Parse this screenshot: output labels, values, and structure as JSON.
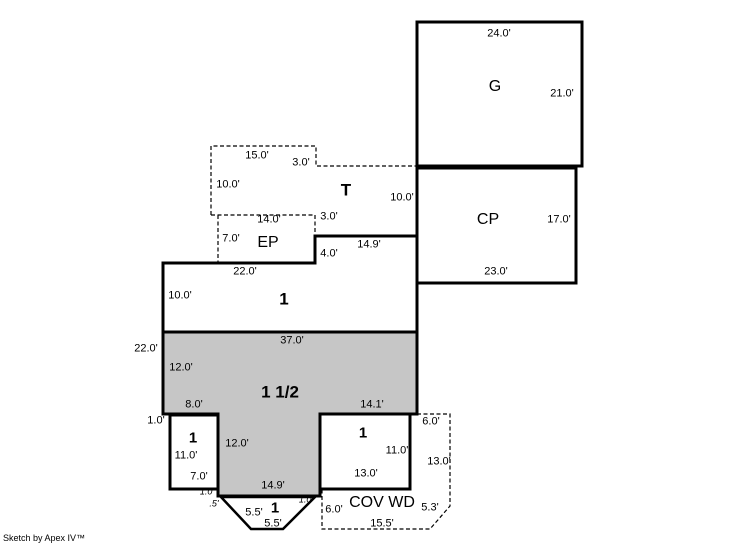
{
  "colors": {
    "background": "#ffffff",
    "line": "#000000",
    "shade": "#c6c6c6"
  },
  "sketch": {
    "garage": {
      "label": "G",
      "dim_top": "24.0'",
      "dim_right": "21.0'"
    },
    "carport": {
      "label": "CP",
      "dim_right": "17.0'",
      "dim_bottom": "23.0'"
    },
    "terrace": {
      "label": "T",
      "dim_top": "15.0'",
      "dim_top_step": "3.0'",
      "dim_left": "10.0'",
      "dim_right": "10.0'"
    },
    "enclosed_porch": {
      "label": "EP",
      "dim_top": "14.0'",
      "dim_right": "3.0'",
      "dim_left": "7.0'"
    },
    "first_floor": {
      "label": "1",
      "dim_top": "22.0'",
      "dim_left": "10.0'",
      "dim_step": "4.0'",
      "dim_top_right": "14.9'"
    },
    "half_story": {
      "label": "1 1/2",
      "dim_top": "37.0'",
      "dim_outer_left": "22.0'",
      "dim_left": "12.0'",
      "dim_bottom_left": "8.0'",
      "dim_bottom_right": "14.1'",
      "dim_col_left": "12.0'",
      "dim_col_bottom": "14.9'"
    },
    "room_left": {
      "label": "1",
      "dim_offset": "1.0'",
      "dim_left": "11.0'",
      "dim_bottom": "7.0'"
    },
    "room_right": {
      "label": "1",
      "dim_right": "11.0'",
      "dim_bottom": "13.0'"
    },
    "bay": {
      "label": "1",
      "dim_step_top": "1.0'",
      "dim_step_left": ".5'",
      "dim_step_right": "1.0'",
      "dim_diag_left": "5.5'",
      "dim_bottom": "5.5'"
    },
    "cov_wd": {
      "label": "COV WD",
      "dim_top": "6.0'",
      "dim_right": "13.0'",
      "dim_diag": "5.3'",
      "dim_bottom": "15.5'",
      "dim_left": "6.0'"
    },
    "footer": "Sketch by Apex IV™"
  }
}
